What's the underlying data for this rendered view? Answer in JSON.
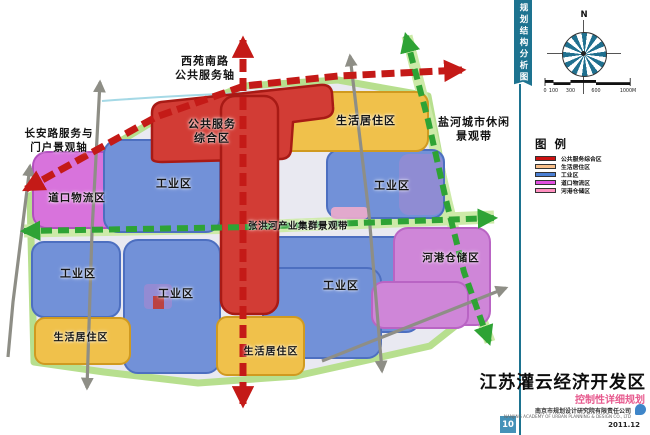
{
  "colors": {
    "public_service_fill": "#d23c35",
    "residential_fill": "#f0c14b",
    "industrial_fill": "#7291d8",
    "logistics_fill": "#d873dc",
    "storage_fill": "#cf86d8",
    "axis_red": "#c41a17",
    "axis_green": "#2ea335",
    "road_gray": "#8e8e86",
    "belt_green": "#b7df8e",
    "sidebar_blue": "#1d7390",
    "pagebox_blue": "#4592b8",
    "subtitle_pink": "#e75a8e",
    "compass_teal": "#20708f"
  },
  "sidebar": {
    "tab_vertical_title": "规划结构分析图",
    "page_number": "10"
  },
  "map": {
    "axis_labels": {
      "xiyuan": "西苑南路\n公共服务轴",
      "changan": "长安路服务与\n门户景观轴",
      "yanhe": "盐河城市休闲\n景观带",
      "zhanghong": "张洪河产业集群景观带"
    },
    "zone_labels": {
      "public_service": "公共服务\n综合区",
      "residential_tr": "生活居住区",
      "residential_bl": "生活居住区",
      "residential_bc": "生活居住区",
      "industrial_ul": "工业区",
      "industrial_r": "工业区",
      "industrial_bl": "工业区",
      "industrial_bc": "工业区",
      "industrial_br": "工业区",
      "logistics": "道口物流区",
      "storage": "河港仓储区"
    }
  },
  "compass": {
    "north_label": "N"
  },
  "scalebar": {
    "ticks": [
      "0",
      "100",
      "300",
      "600",
      "1000M"
    ]
  },
  "legend": {
    "title": "图 例",
    "items": [
      {
        "label": "公共服务综合区",
        "color": "#cc1111"
      },
      {
        "label": "生活居住区",
        "color": "#f9c08a"
      },
      {
        "label": "工业区",
        "color": "#4a7fd4"
      },
      {
        "label": "道口物流区",
        "color": "#e04fe0"
      },
      {
        "label": "河港仓储区",
        "color": "#ff8fc0"
      }
    ]
  },
  "titleblock": {
    "title": "江苏灌云经济开发区",
    "subtitle": "控制性详细规划",
    "company": "南京市规划设计研究院有限责任公司",
    "company_en": "NANJING ACADEMY OF URBAN PLANNING & DESIGN CO., LTD",
    "date": "2011.12"
  }
}
